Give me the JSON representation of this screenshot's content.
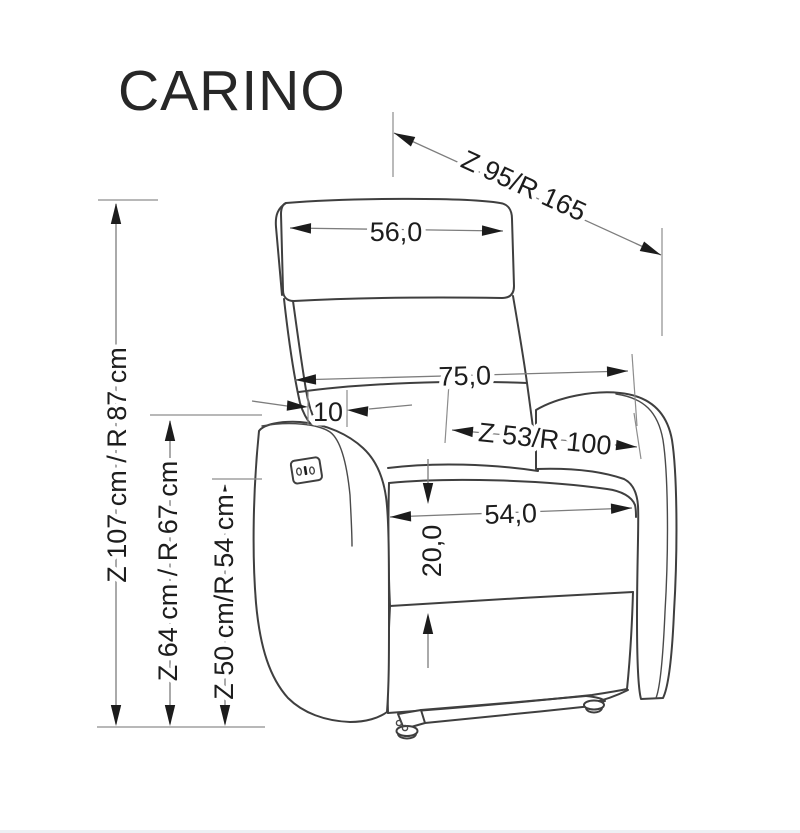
{
  "title": "CARINO",
  "drawing": {
    "dimensions": {
      "reclined_total_length": "Z 95/R 165",
      "headrest_width": "56,0",
      "backrest_width": "75,0",
      "backrest_armrest_gap": "10",
      "seat_depth": "Z 53/R 100",
      "seat_width": "54,0",
      "seat_cushion_front_height": "20,0",
      "total_height": "Z 107 cm / R 87 cm",
      "armrest_height": "Z 64 cm / R 67 cm",
      "seat_height": "Z 50 cm/R 54 cm"
    },
    "colors": {
      "background": "#ffffff",
      "outline": "#3f3f3f",
      "dimension_line": "#7d7d7d",
      "arrow": "#1c1c1c",
      "text": "#1d1d1d"
    }
  }
}
